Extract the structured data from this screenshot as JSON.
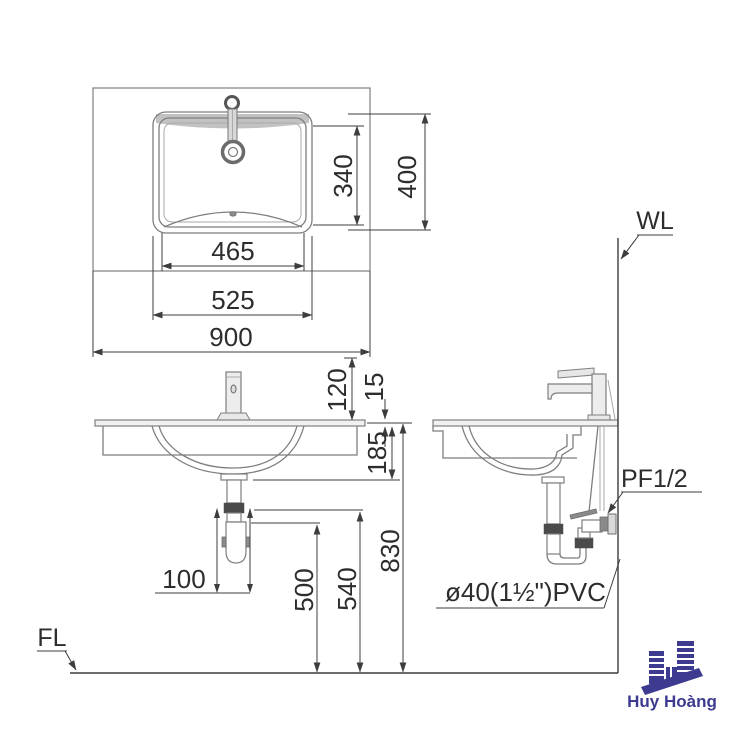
{
  "dims": {
    "top": {
      "basin_width": "465",
      "rim_width": "525",
      "counter_width": "900",
      "basin_depth": "340",
      "rim_depth": "400"
    },
    "front": {
      "faucet_height": "120",
      "countertop_thickness": "15",
      "bowl_depth": "185",
      "drain_offset": "100",
      "waste_outlet_height": "500",
      "popup_rod_height": "540",
      "counter_height": "830"
    }
  },
  "labels": {
    "wall_line": "WL",
    "floor_line": "FL",
    "water_supply": "PF1/2",
    "drain_pipe": "ø40(1½\")PVC"
  },
  "logo": {
    "brand": "Huy Hoàng",
    "color": "#3c3b90"
  },
  "colors": {
    "object_line": "#7e7e7e",
    "dimension_line": "#3d3d3d",
    "background": "#ffffff"
  }
}
